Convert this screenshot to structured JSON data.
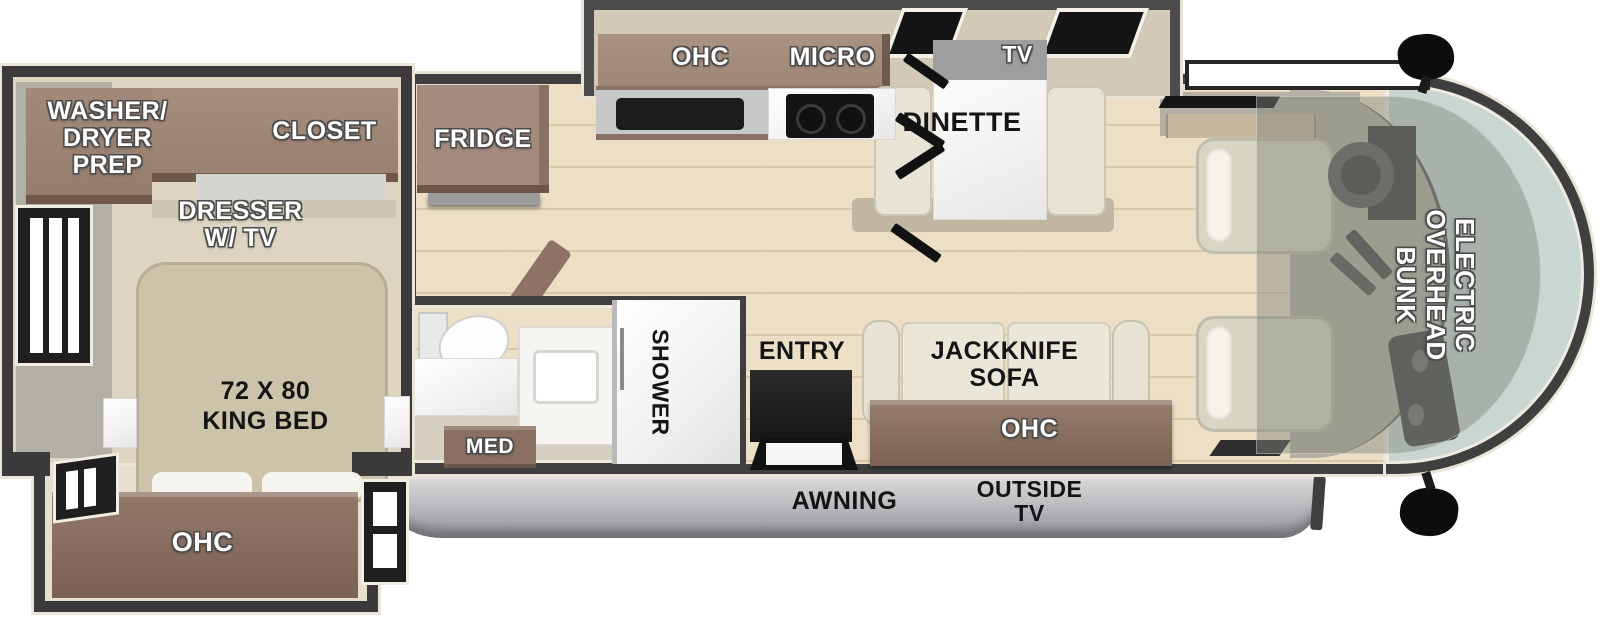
{
  "diagram": {
    "type": "rv-floorplan-top-view",
    "colors": {
      "wall": "#3f3f3f",
      "trim": "#ebe5d8",
      "floor_wood": "#ecdfc6",
      "cabinet_taupe": "#9d8576",
      "cabinet_dark_brown": "#85695b",
      "bed_beige": "#cdc3aa",
      "cushion_cream": "#e9e5d6",
      "counter_gray": "#c8c8c8",
      "marble_white": "#f4f3f1",
      "awning_gray": "#aeafb3",
      "windshield_glass": "#c9d6d2",
      "bunk_overlay": "rgba(128,132,122,0.45)"
    },
    "labels": {
      "washer_dryer_prep": "WASHER/\nDRYER\nPREP",
      "closet": "CLOSET",
      "dresser_tv": "DRESSER\nW/ TV",
      "king_bed": "72 X 80\nKING BED",
      "ohc_bedroom": "OHC",
      "fridge": "FRIDGE",
      "ohc_kitchen": "OHC",
      "micro": "MICRO",
      "tv_dinette": "TV",
      "dinette": "DINETTE",
      "med": "MED",
      "shower": "SHOWER",
      "entry": "ENTRY",
      "jackknife_sofa": "JACKKNIFE\nSOFA",
      "ohc_living": "OHC",
      "awning": "AWNING",
      "outside_tv": "OUTSIDE\nTV",
      "electric_overhead_bunk": "ELECTRIC\nOVERHEAD\nBUNK"
    }
  }
}
